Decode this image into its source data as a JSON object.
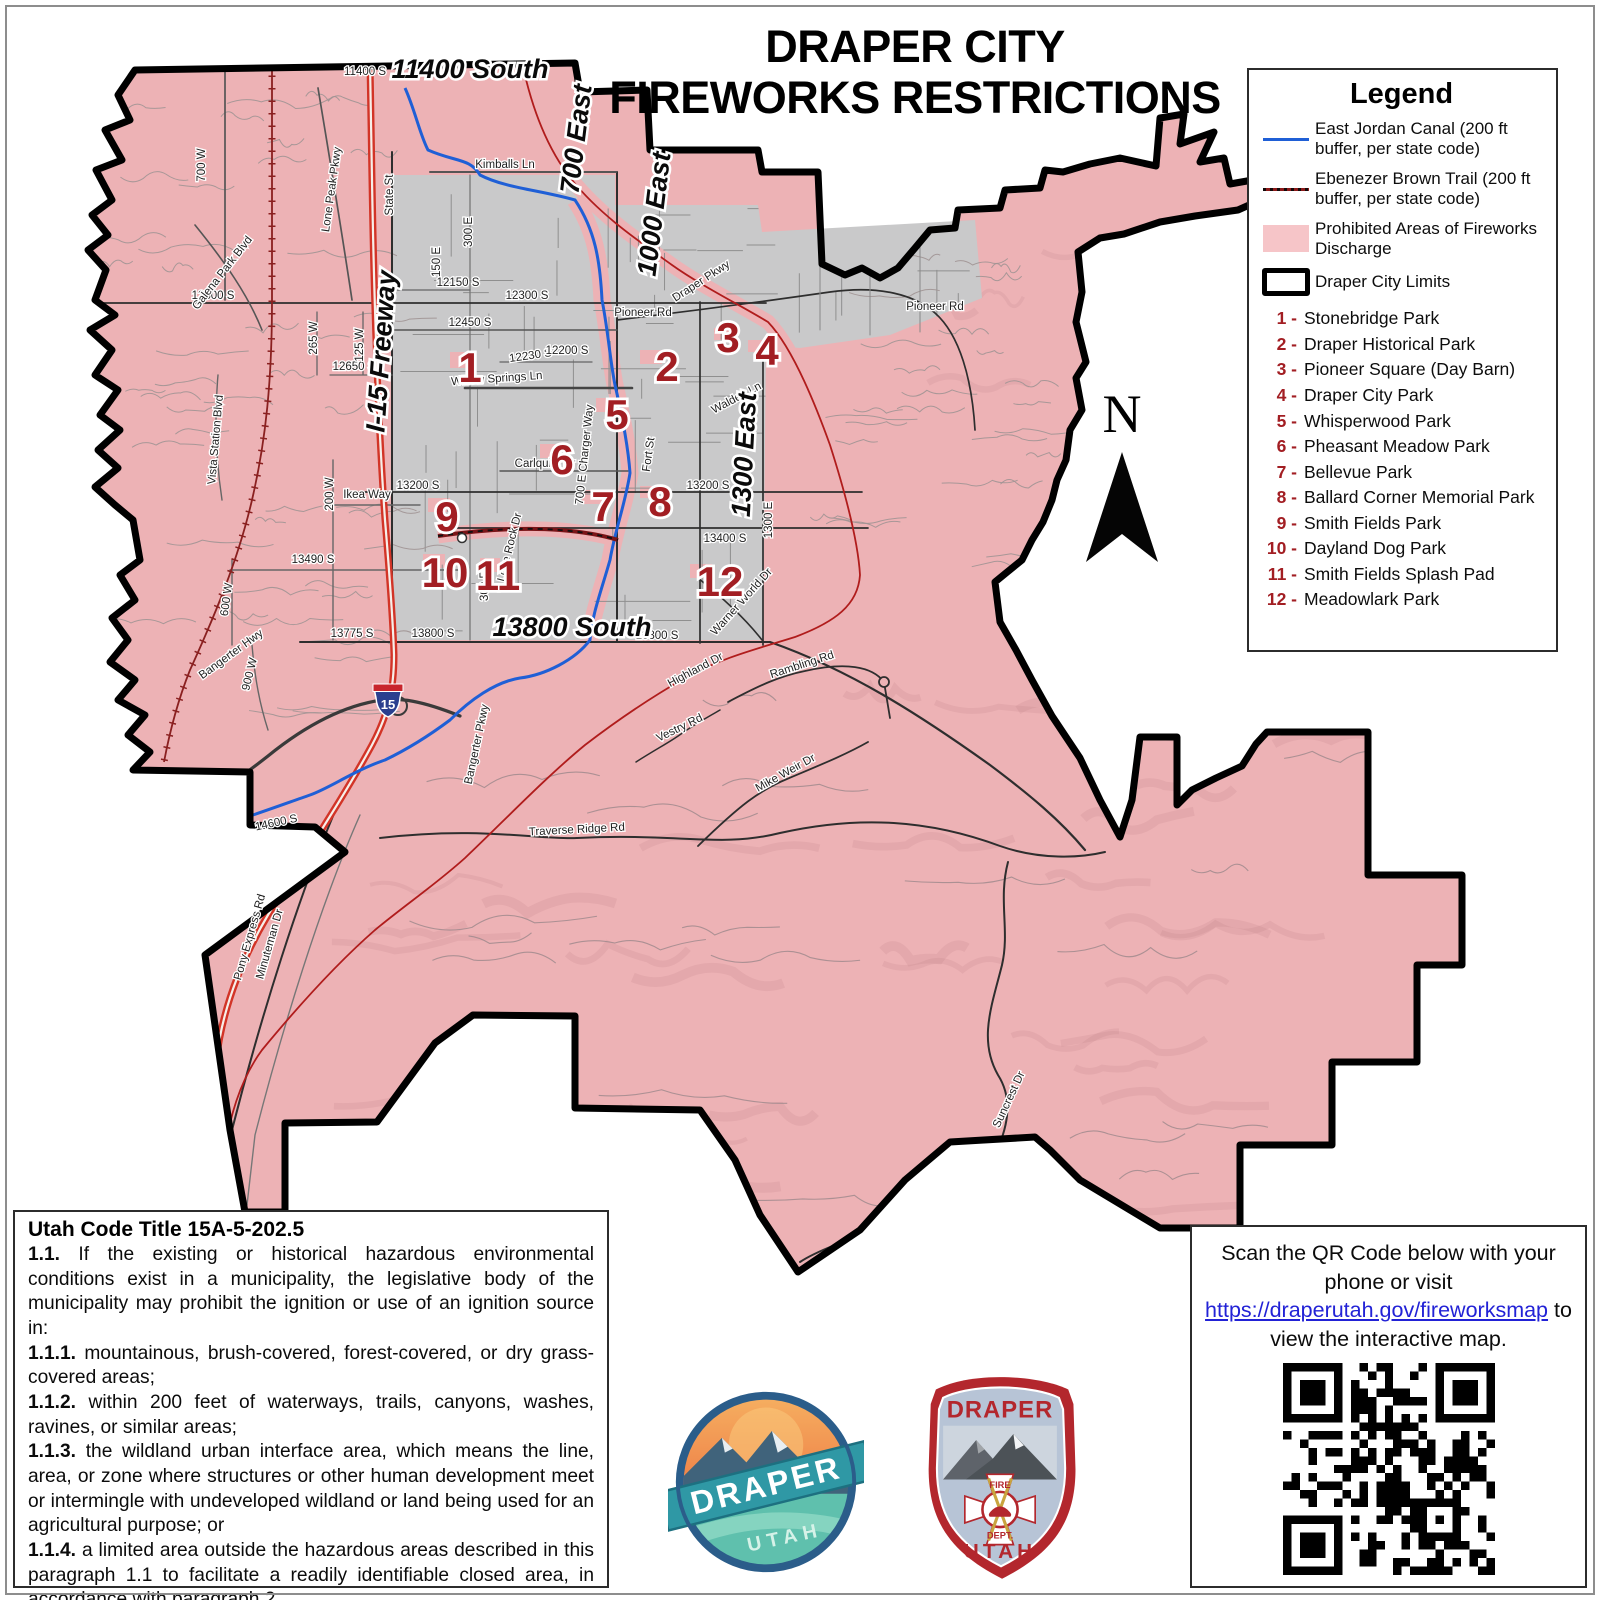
{
  "title": {
    "line1": "DRAPER CITY",
    "line2": "FIREWORKS RESTRICTIONS"
  },
  "legend": {
    "title": "Legend",
    "items": [
      {
        "symbol": "blue-line",
        "label": "East Jordan Canal (200 ft buffer, per state code)"
      },
      {
        "symbol": "red-dashed-line",
        "label": "Ebenezer Brown Trail (200 ft buffer, per state code)"
      },
      {
        "symbol": "pink-swatch",
        "label": "Prohibited Areas of Fireworks Discharge"
      },
      {
        "symbol": "black-outline",
        "label": "Draper City Limits"
      }
    ],
    "parks": [
      {
        "num": "1 -",
        "name": "Stonebridge Park"
      },
      {
        "num": "2 -",
        "name": "Draper Historical Park"
      },
      {
        "num": "3 -",
        "name": "Pioneer Square (Day Barn)"
      },
      {
        "num": "4 -",
        "name": "Draper City Park"
      },
      {
        "num": "5 -",
        "name": "Whisperwood Park"
      },
      {
        "num": "6 -",
        "name": "Pheasant Meadow Park"
      },
      {
        "num": "7 -",
        "name": "Bellevue Park"
      },
      {
        "num": "8 -",
        "name": "Ballard Corner Memorial Park"
      },
      {
        "num": "9 -",
        "name": "Smith Fields Park"
      },
      {
        "num": "10 -",
        "name": "Dayland Dog Park"
      },
      {
        "num": "11 -",
        "name": "Smith Fields Splash Pad"
      },
      {
        "num": "12 -",
        "name": "Meadowlark Park"
      }
    ]
  },
  "map": {
    "north_label": "N",
    "shield_label": "15",
    "colors": {
      "prohibited": "#edb2b5",
      "allowed_gray": "#c9c9ca",
      "canal_blue": "#1f5fd6",
      "trail_red": "#8c1a1a",
      "marker_red": "#a21e23",
      "boundary": "#000000"
    },
    "big_labels": [
      {
        "text": "11400 South",
        "x": 470,
        "y": 78,
        "r": 0
      },
      {
        "text": "700 East",
        "x": 585,
        "y": 140,
        "r": -83
      },
      {
        "text": "1000 East",
        "x": 663,
        "y": 215,
        "r": -83
      },
      {
        "text": "1300 East",
        "x": 753,
        "y": 455,
        "r": -87
      },
      {
        "text": "13800 South",
        "x": 572,
        "y": 636,
        "r": 0
      },
      {
        "text": "I-15 Freeway",
        "x": 390,
        "y": 352,
        "r": -86
      }
    ],
    "street_labels": [
      {
        "text": "Kimballs Ln",
        "x": 505,
        "y": 168,
        "r": 0
      },
      {
        "text": "Willow Springs Ln",
        "x": 497,
        "y": 382,
        "r": -4
      },
      {
        "text": "Pioneer Rd",
        "x": 643,
        "y": 316,
        "r": 0
      },
      {
        "text": "Pioneer Rd",
        "x": 935,
        "y": 310,
        "r": 0
      },
      {
        "text": "Draper Pkwy",
        "x": 703,
        "y": 284,
        "r": -33
      },
      {
        "text": "12150 S",
        "x": 458,
        "y": 286,
        "r": 0
      },
      {
        "text": "12300 S",
        "x": 527,
        "y": 299,
        "r": 0
      },
      {
        "text": "12300 S",
        "x": 213,
        "y": 299,
        "r": 0
      },
      {
        "text": "12450 S",
        "x": 470,
        "y": 326,
        "r": 0
      },
      {
        "text": "12230 S",
        "x": 531,
        "y": 359,
        "r": -8
      },
      {
        "text": "12200 S",
        "x": 567,
        "y": 354,
        "r": 0
      },
      {
        "text": "12650 S",
        "x": 354,
        "y": 370,
        "r": 0
      },
      {
        "text": "13200 S",
        "x": 418,
        "y": 489,
        "r": 0
      },
      {
        "text": "13200 S",
        "x": 708,
        "y": 489,
        "r": 0
      },
      {
        "text": "13400 S",
        "x": 725,
        "y": 542,
        "r": 0
      },
      {
        "text": "13490 S",
        "x": 313,
        "y": 563,
        "r": 0
      },
      {
        "text": "13775 S",
        "x": 352,
        "y": 637,
        "r": 0
      },
      {
        "text": "13800 S",
        "x": 433,
        "y": 637,
        "r": 0
      },
      {
        "text": "13800 S",
        "x": 657,
        "y": 639,
        "r": 0
      },
      {
        "text": "14600 S",
        "x": 277,
        "y": 826,
        "r": -12
      },
      {
        "text": "State St",
        "x": 393,
        "y": 195,
        "r": -90
      },
      {
        "text": "300 E",
        "x": 472,
        "y": 232,
        "r": -90
      },
      {
        "text": "150 E",
        "x": 440,
        "y": 262,
        "r": -90
      },
      {
        "text": "300 E",
        "x": 488,
        "y": 586,
        "r": -90
      },
      {
        "text": "700 E Charger Way",
        "x": 588,
        "y": 455,
        "r": -84
      },
      {
        "text": "Fort St",
        "x": 652,
        "y": 455,
        "r": -82
      },
      {
        "text": "Walden Ln",
        "x": 738,
        "y": 401,
        "r": -28
      },
      {
        "text": "1300 E",
        "x": 772,
        "y": 520,
        "r": -90
      },
      {
        "text": "Carlquist Dr",
        "x": 545,
        "y": 467,
        "r": 0
      },
      {
        "text": "Lone Rock Dr",
        "x": 513,
        "y": 548,
        "r": -76
      },
      {
        "text": "700 W",
        "x": 205,
        "y": 165,
        "r": -90
      },
      {
        "text": "Lone Peak Pkwy",
        "x": 335,
        "y": 190,
        "r": -82
      },
      {
        "text": "Galena Park Blvd",
        "x": 225,
        "y": 275,
        "r": -52
      },
      {
        "text": "Vista Station Blvd",
        "x": 219,
        "y": 440,
        "r": -85
      },
      {
        "text": "Ikea Way",
        "x": 367,
        "y": 498,
        "r": 0
      },
      {
        "text": "265 W",
        "x": 317,
        "y": 338,
        "r": -90
      },
      {
        "text": "125 W",
        "x": 363,
        "y": 345,
        "r": -90
      },
      {
        "text": "200 W",
        "x": 333,
        "y": 494,
        "r": -90
      },
      {
        "text": "600 W",
        "x": 230,
        "y": 600,
        "r": -82
      },
      {
        "text": "900 W",
        "x": 253,
        "y": 675,
        "r": -76
      },
      {
        "text": "Bangerter Hwy",
        "x": 233,
        "y": 657,
        "r": -36
      },
      {
        "text": "Bangerter Pkwy",
        "x": 480,
        "y": 745,
        "r": -78
      },
      {
        "text": "Pony Express Rd",
        "x": 253,
        "y": 938,
        "r": -74
      },
      {
        "text": "Minuteman Dr",
        "x": 273,
        "y": 945,
        "r": -74
      },
      {
        "text": "Highland Dr",
        "x": 697,
        "y": 673,
        "r": -28
      },
      {
        "text": "Rambling Rd",
        "x": 803,
        "y": 668,
        "r": -18
      },
      {
        "text": "Vestry Rd",
        "x": 681,
        "y": 731,
        "r": -26
      },
      {
        "text": "Mike Weir Dr",
        "x": 787,
        "y": 776,
        "r": -29
      },
      {
        "text": "Traverse Ridge Rd",
        "x": 577,
        "y": 833,
        "r": -3
      },
      {
        "text": "Suncrest Dr",
        "x": 1012,
        "y": 1101,
        "r": -65
      },
      {
        "text": "Warner World Dr",
        "x": 744,
        "y": 604,
        "r": -48
      },
      {
        "text": "11400 S",
        "x": 365,
        "y": 75,
        "r": 0
      }
    ],
    "markers": [
      {
        "num": "1",
        "x": 470,
        "y": 382
      },
      {
        "num": "2",
        "x": 667,
        "y": 381
      },
      {
        "num": "3",
        "x": 728,
        "y": 352
      },
      {
        "num": "4",
        "x": 767,
        "y": 365
      },
      {
        "num": "5",
        "x": 617,
        "y": 429
      },
      {
        "num": "6",
        "x": 562,
        "y": 474
      },
      {
        "num": "7",
        "x": 603,
        "y": 521
      },
      {
        "num": "8",
        "x": 660,
        "y": 516
      },
      {
        "num": "9",
        "x": 447,
        "y": 531
      },
      {
        "num": "10",
        "x": 445,
        "y": 587
      },
      {
        "num": "11",
        "x": 498,
        "y": 590
      },
      {
        "num": "12",
        "x": 720,
        "y": 596
      }
    ]
  },
  "utah_code": {
    "title": "Utah Code Title 15A-5-202.5",
    "paragraphs": [
      {
        "num": "1.1.",
        "text": " If the existing or historical hazardous environmental conditions exist in a municipality, the legislative body of the municipality may prohibit the ignition or use of an ignition source in:"
      },
      {
        "num": "1.1.1.",
        "text": " mountainous, brush-covered, forest-covered, or dry grass-covered areas;"
      },
      {
        "num": "1.1.2.",
        "text": " within 200 feet of waterways, trails, canyons, washes, ravines, or similar areas;"
      },
      {
        "num": "1.1.3.",
        "text": " the wildland urban interface area, which means the line, area, or zone where structures or other human development meet or intermingle with undeveloped wildland or land being used for an agricultural purpose; or"
      },
      {
        "num": "1.1.4.",
        "text": " a limited area outside the hazardous areas described in this paragraph 1.1 to facilitate a readily identifiable closed area, in accordance with paragraph 2."
      }
    ]
  },
  "qr_box": {
    "text_before": "Scan the QR Code below with your phone or visit ",
    "link_text": "https://draperutah.gov/fireworksmap",
    "link_href": "https://draperutah.gov/fireworksmap",
    "text_after": " to view the interactive map."
  },
  "logos": {
    "draper": {
      "name": "DRAPER",
      "sub": "UTAH"
    },
    "fire": {
      "top": "DRAPER",
      "center_top": "FIRE",
      "center_bottom": "DEPT.",
      "bottom": "UTAH"
    }
  }
}
